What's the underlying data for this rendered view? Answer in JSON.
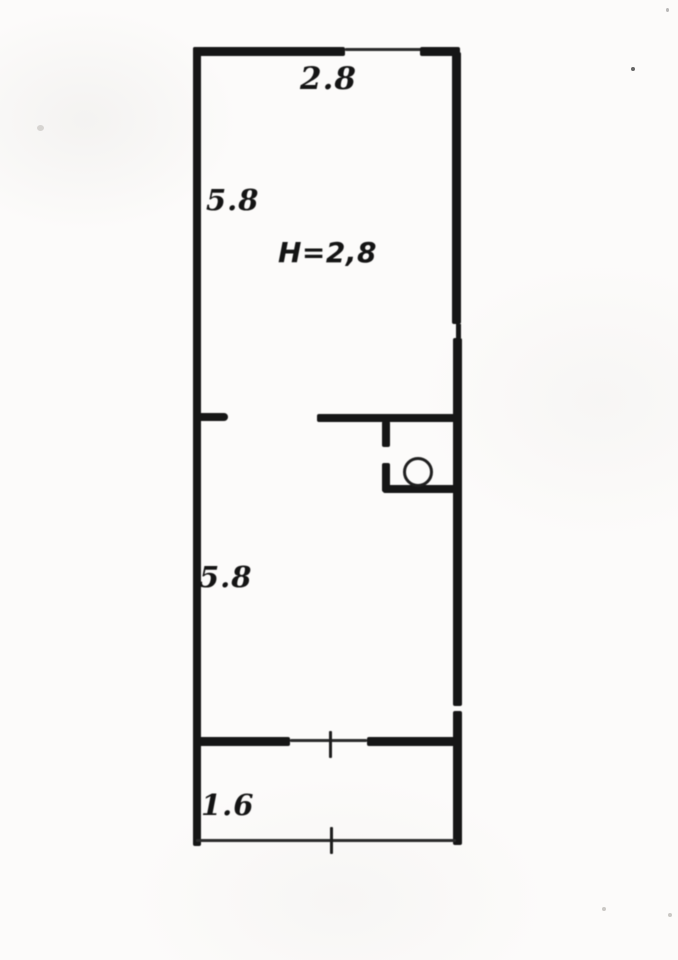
{
  "plan": {
    "type": "apartment-floor-plan",
    "labels": {
      "top_width": "2.8",
      "upper_room_depth": "5.8",
      "ceiling_height": "H=2,8",
      "lower_room_depth": "5.8",
      "balcony_depth": "1.6"
    },
    "colors": {
      "wall": "#161616",
      "background": "#fcfbfa"
    }
  }
}
